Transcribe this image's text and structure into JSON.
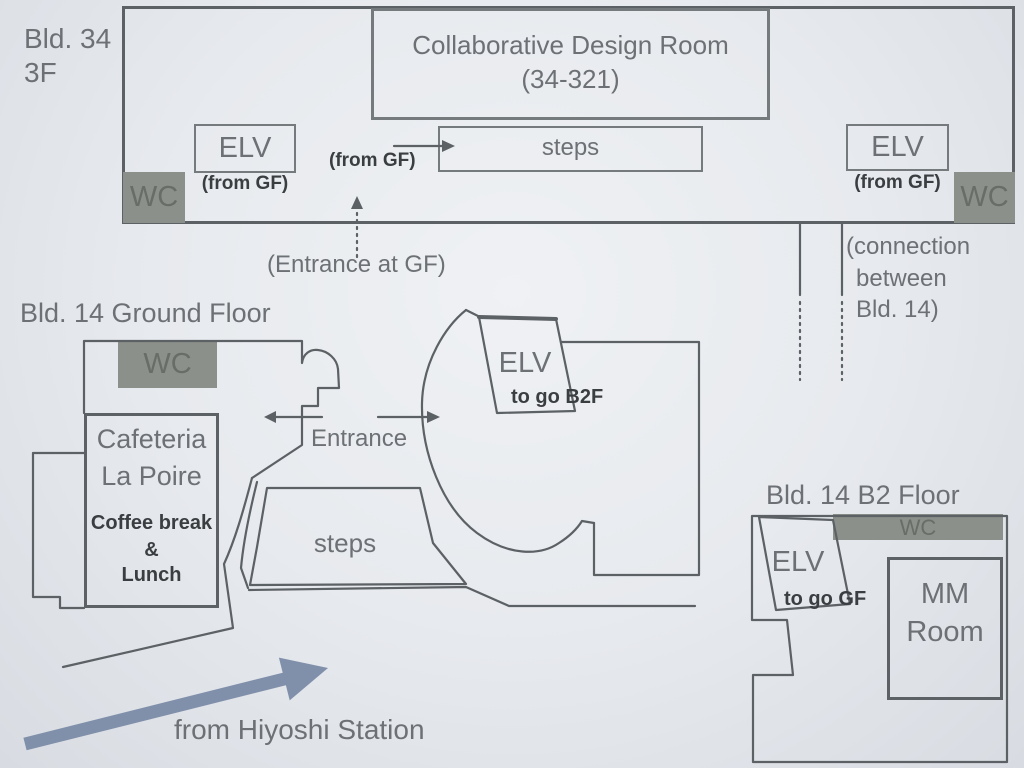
{
  "palette": {
    "stroke_dark": "#5c6165",
    "stroke_box": "#757a7d",
    "text_gray": "#6d7175",
    "text_dark": "#3b3e41",
    "gray_fill": "#8b908a",
    "gray_fill_text": "#686d68",
    "blue_arrow": "#8090ab"
  },
  "bld34": {
    "name_line1": "Bld. 34",
    "name_line2": "3F",
    "room_line1": "Collaborative Design Room",
    "room_line2": "(34-321)",
    "elv_left_label": "ELV",
    "elv_left_note": "(from GF)",
    "wc_left": "WC",
    "from_gf_note": "(from GF)",
    "steps_label": "steps",
    "elv_right_label": "ELV",
    "elv_right_note": "(from GF)",
    "wc_right": "WC",
    "entrance_note": "(Entrance at GF)",
    "connection_line1": "(connection",
    "connection_line2": "between",
    "connection_line3": "Bld. 14)"
  },
  "bld14_gf": {
    "title": "Bld. 14 Ground Floor",
    "wc": "WC",
    "cafeteria_line1": "Cafeteria",
    "cafeteria_line2": "La Poire",
    "cafeteria_sub1": "Coffee break",
    "cafeteria_sub2": "&",
    "cafeteria_sub3": "Lunch",
    "entrance_label": "Entrance",
    "elv_label": "ELV",
    "elv_note": "to go B2F",
    "steps_label": "steps"
  },
  "bld14_b2": {
    "title": "Bld. 14 B2 Floor",
    "wc": "WC",
    "elv_label": "ELV",
    "elv_note": "to go GF",
    "mm_line1": "MM",
    "mm_line2": "Room"
  },
  "route": {
    "from_station": "from Hiyoshi Station"
  }
}
